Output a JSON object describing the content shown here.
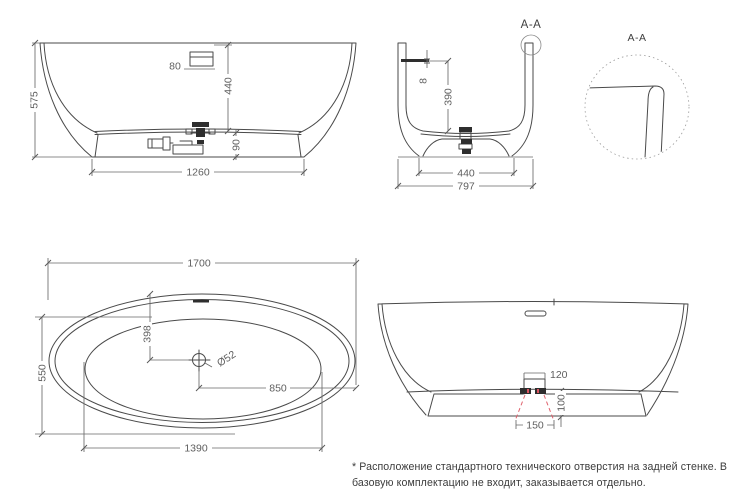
{
  "document": {
    "type": "bathtub-technical-drawing"
  },
  "colors": {
    "line": "#4a4a4a",
    "dimension_line": "#6a6a6a",
    "dimension_text": "#5f5f5f",
    "hole_marking_red": "#e0636e",
    "background": "#ffffff"
  },
  "views": {
    "front_elevation": {
      "dimensions": {
        "overall_height": "575",
        "overflow_offset": "80",
        "rim_to_base": "440",
        "plinth_height": "90",
        "base_length": "1260"
      }
    },
    "cross_section": {
      "section_label": "A-A",
      "dimensions": {
        "overflow_slot_height": "8",
        "overflow_to_bottom": "390",
        "base_width": "440",
        "overall_width": "797"
      }
    },
    "corner_detail": {
      "label": "A-A"
    },
    "plan_view": {
      "dimensions": {
        "overall_length": "1700",
        "overall_width": "550",
        "drain_offset_long": "398",
        "drain_diameter": "Ø52",
        "drain_to_end": "850",
        "basin_length": "1390"
      }
    },
    "rear_elevation": {
      "dimensions": {
        "hole_top_width": "120",
        "hole_bottom_width": "150",
        "plinth_height": "100"
      }
    }
  },
  "footnote": {
    "line1": "* Расположение стандартного технического отверстия на задней стенке. В",
    "line2": "базовую комплектацию не входит, заказывается отдельно."
  }
}
